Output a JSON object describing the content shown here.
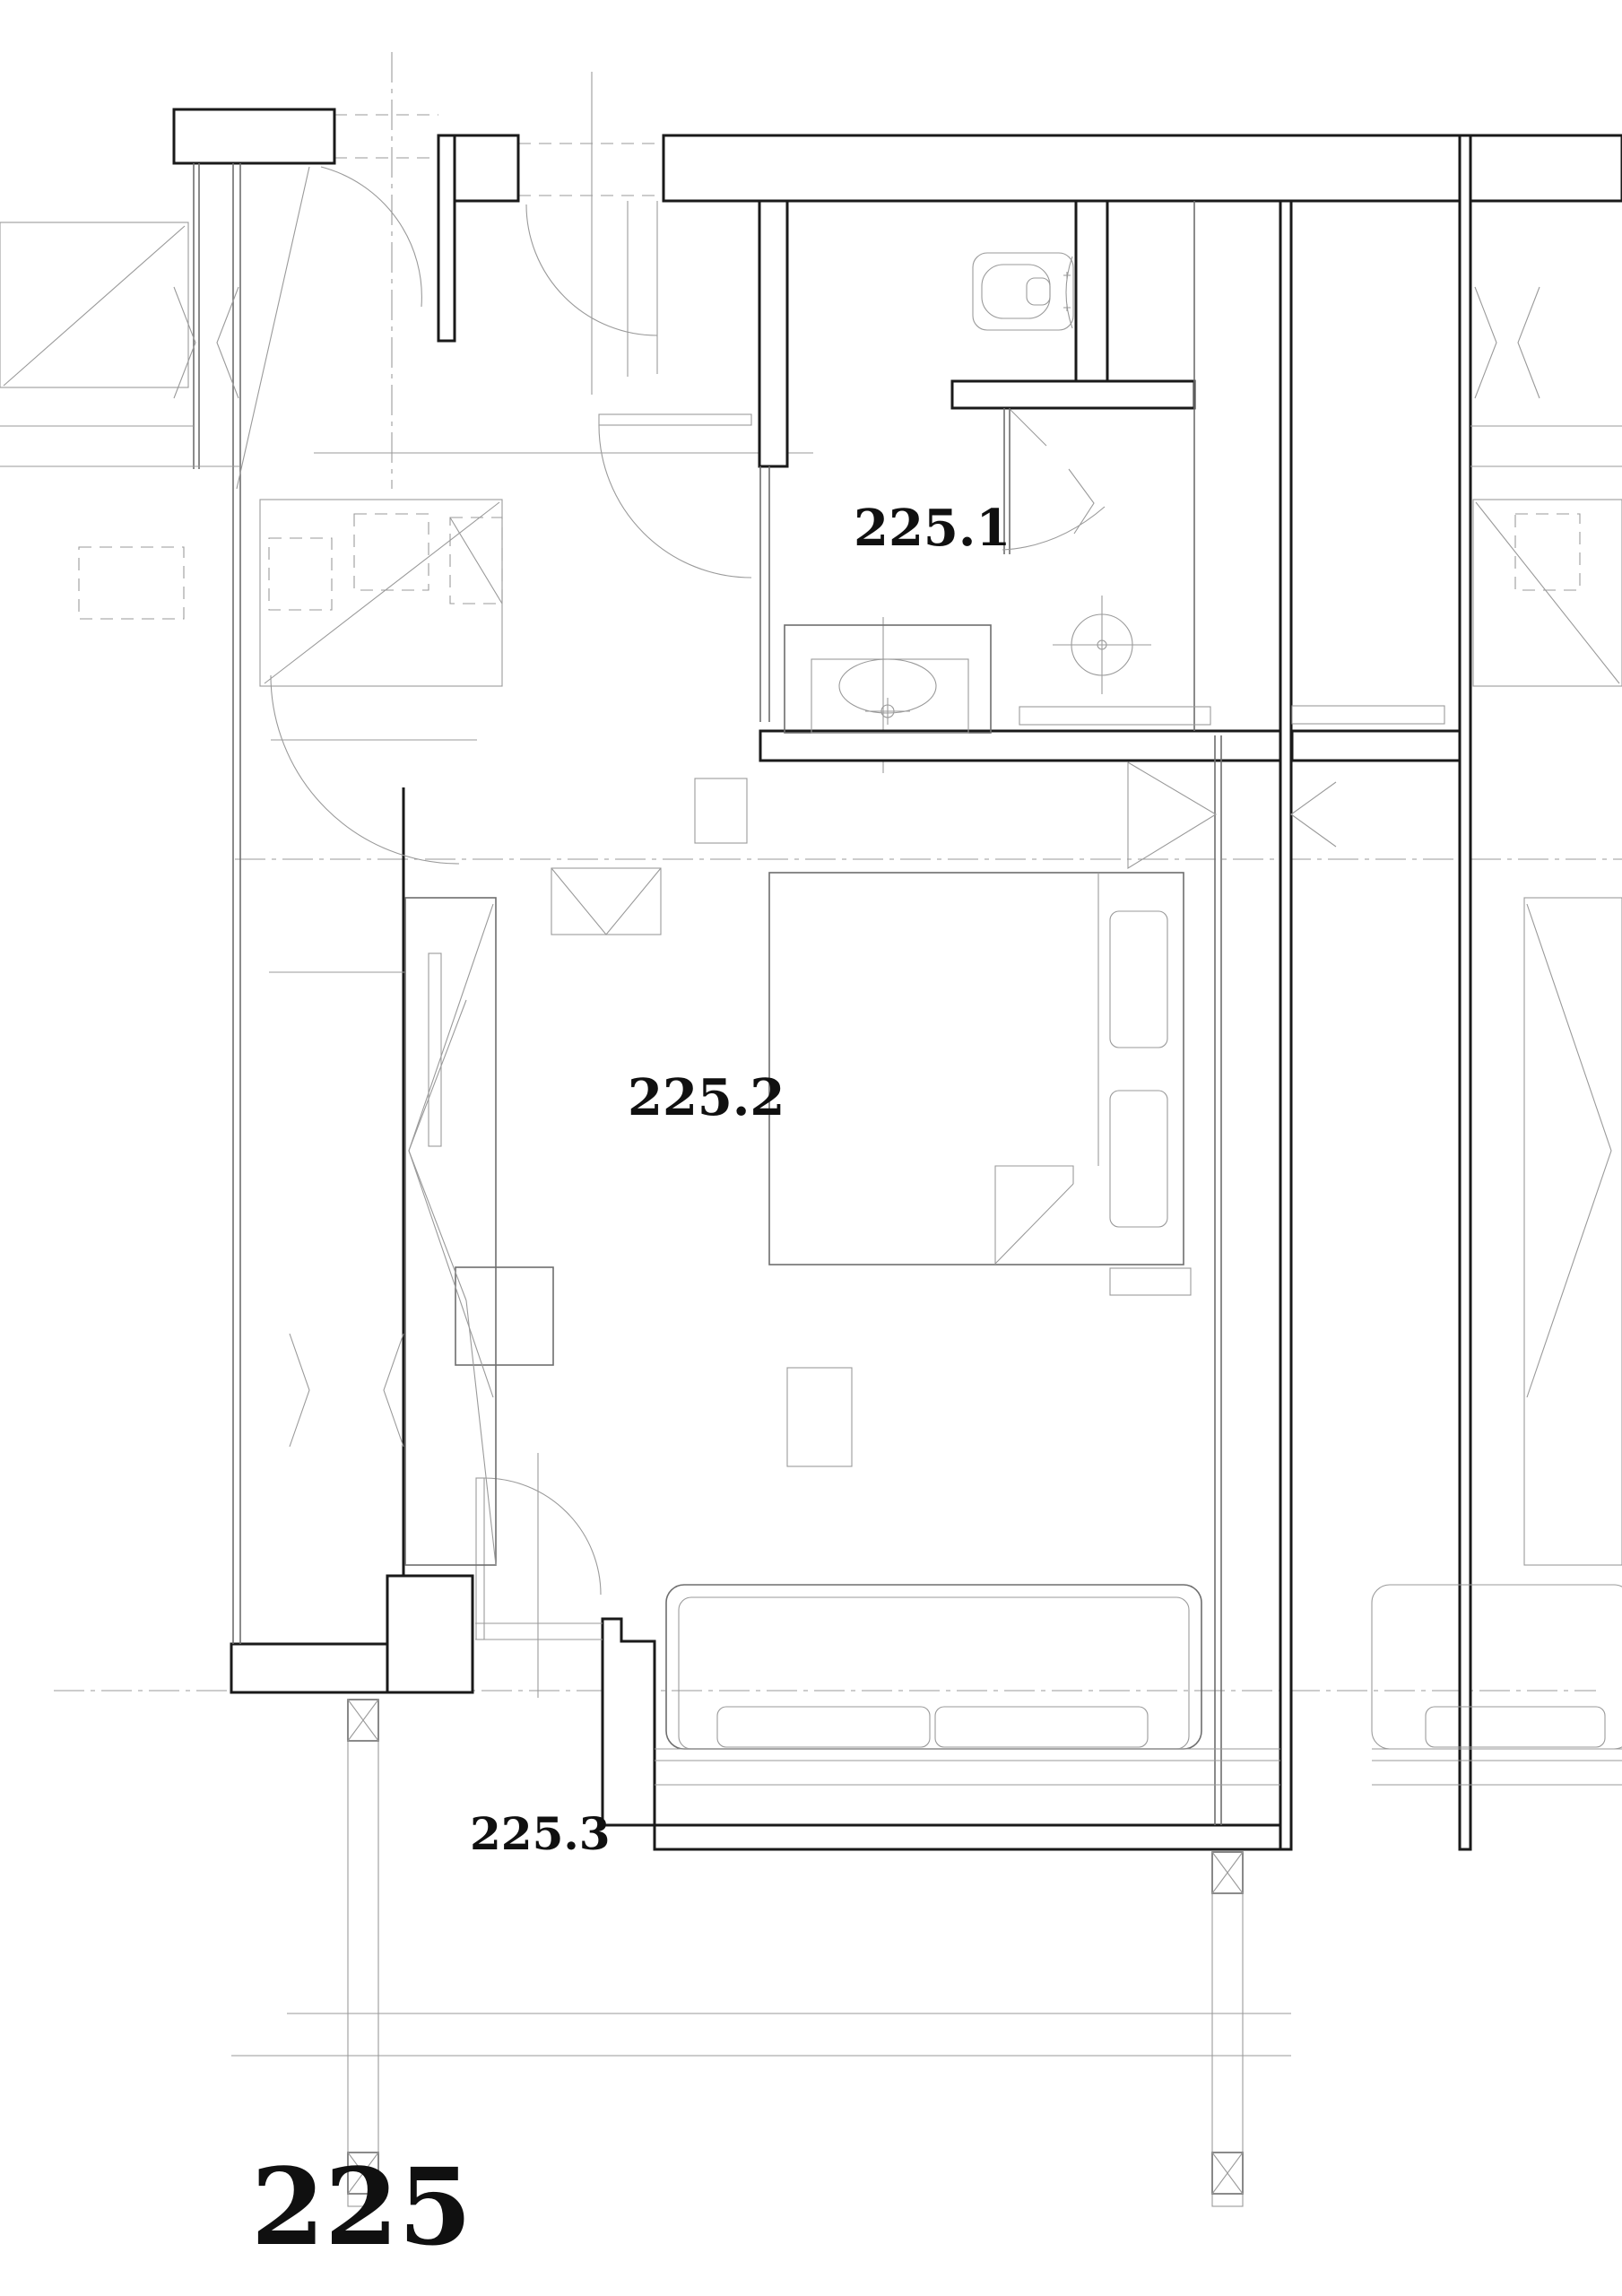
{
  "labels": {
    "bathroom": "225.1",
    "bedroom": "225.2",
    "balcony": "225.3",
    "unit": "225"
  },
  "colors": {
    "paper": "#ffffff",
    "wall_ink": "#1a1a1a",
    "furniture_line": "#6e6e6e",
    "light_line": "#9a9a9a"
  },
  "symbols": {
    "toilet": "toilet-icon",
    "washbasin": "sink-icon",
    "shower_drain": "shower-drain-icon",
    "bifold_shower_door": "bifold-door-icon",
    "door_swing": "door-swing-icon",
    "bed": "bed-icon",
    "sofa": "sofa-icon",
    "wardrobe": "wardrobe-icon",
    "column": "column-icon",
    "section_line": "section-line"
  }
}
